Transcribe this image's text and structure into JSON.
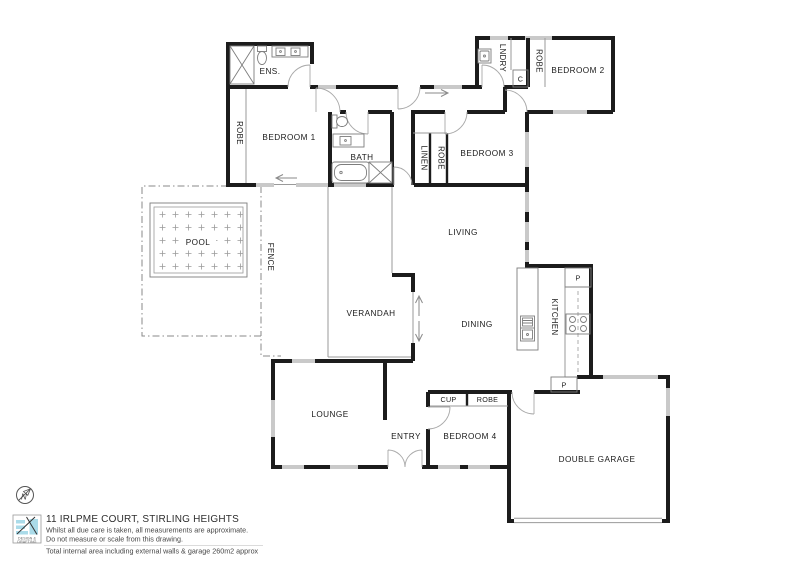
{
  "plan": {
    "rooms": {
      "ens": "ENS.",
      "robe_bed1": "ROBE",
      "bedroom1": "BEDROOM 1",
      "bath": "BATH",
      "linen": "LINEN",
      "robe_bed3": "ROBE",
      "bedroom3": "BEDROOM 3",
      "lndry": "LNDRY",
      "cupboard_c": "C",
      "robe_bed2": "ROBE",
      "bedroom2": "BEDROOM 2",
      "living": "LIVING",
      "pool": "POOL",
      "fence": "FENCE",
      "verandah": "VERANDAH",
      "dining": "DINING",
      "kitchen": "KITCHEN",
      "pantry_top": "P",
      "pantry_bottom": "P",
      "lounge": "LOUNGE",
      "entry": "ENTRY",
      "cup": "CUP",
      "robe_bed4": "ROBE",
      "bedroom4": "BEDROOM 4",
      "double_garage": "DOUBLE GARAGE"
    },
    "compass_north": "N",
    "colors": {
      "wall": "#1c1c1c",
      "window": "#c9c9c9",
      "fixture": "#7d7d7d",
      "logo_accent": "#aadbe9"
    }
  },
  "title_block": {
    "logo_line1": "DESIGN &",
    "logo_line2": "DRAFTING",
    "address": "11 IRLPME COURT, STIRLING HEIGHTS",
    "disclaimer_line1": "Whilst all due care is taken, all measurements are approximate.",
    "disclaimer_line2": "Do not measure or scale from this drawing.",
    "area_note": "Total internal area including external walls & garage 260m2 approx"
  }
}
